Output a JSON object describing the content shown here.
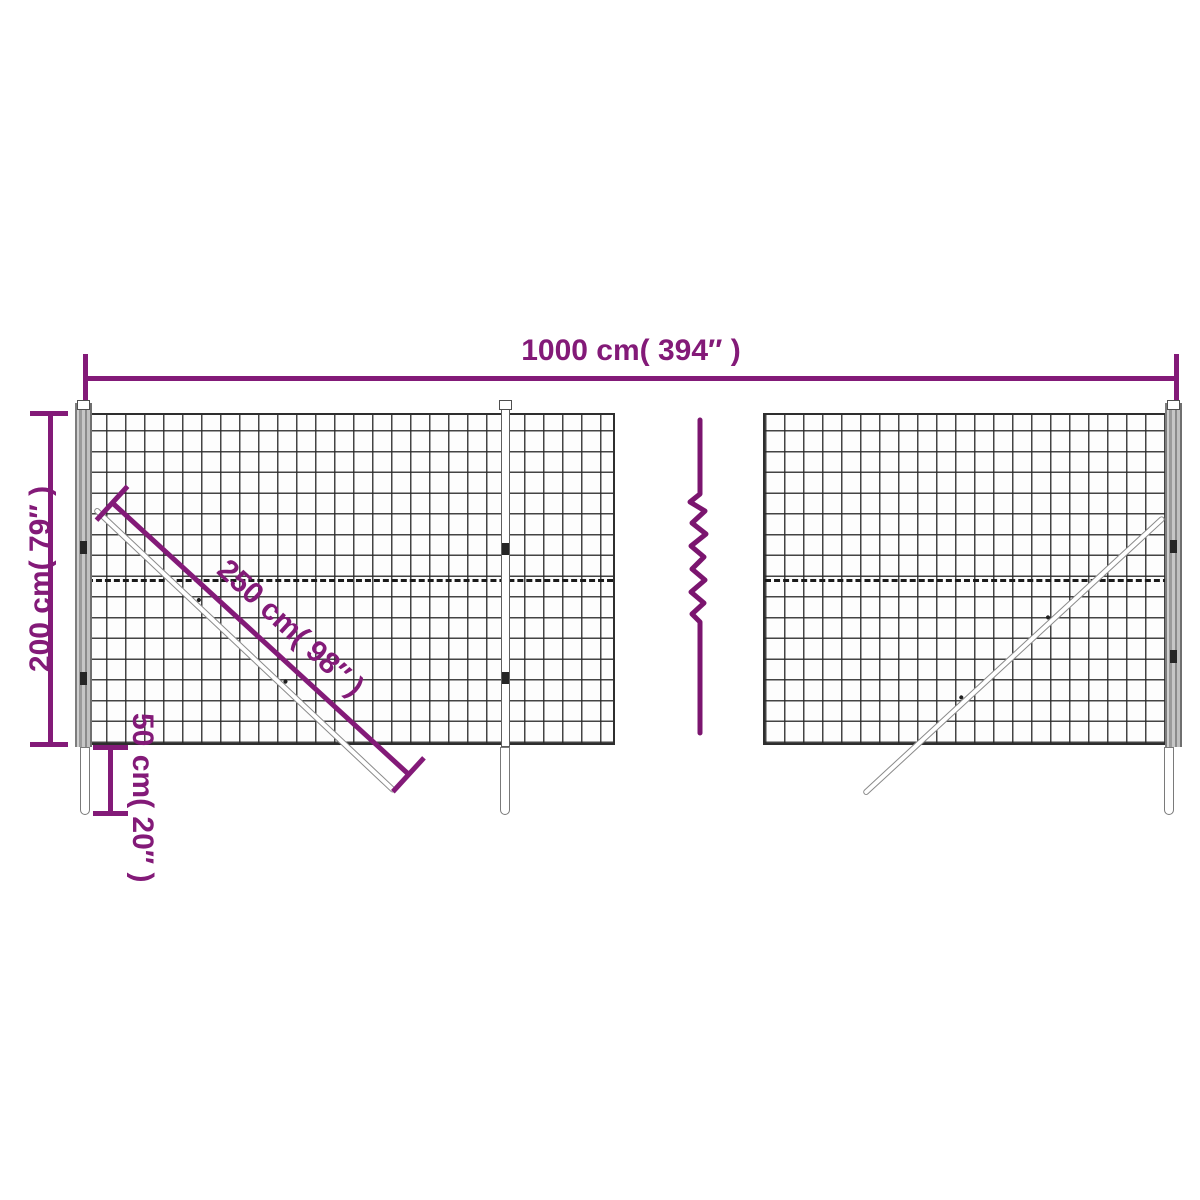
{
  "diagram": {
    "type": "product-dimension-diagram",
    "subject": "wire mesh fence panels with posts, diagonal braces and ground stakes",
    "labels": {
      "total_width": "1000 cm( 394″ )",
      "height": "200 cm( 79″ )",
      "brace_length": "250 cm( 98″ )",
      "stake_depth": "50 cm( 20″ )"
    },
    "colors": {
      "dimension_purple": "#831a78",
      "mesh_line": "#2e2e2e",
      "post_gray": "#9a9a9a",
      "background": "#ffffff"
    }
  }
}
